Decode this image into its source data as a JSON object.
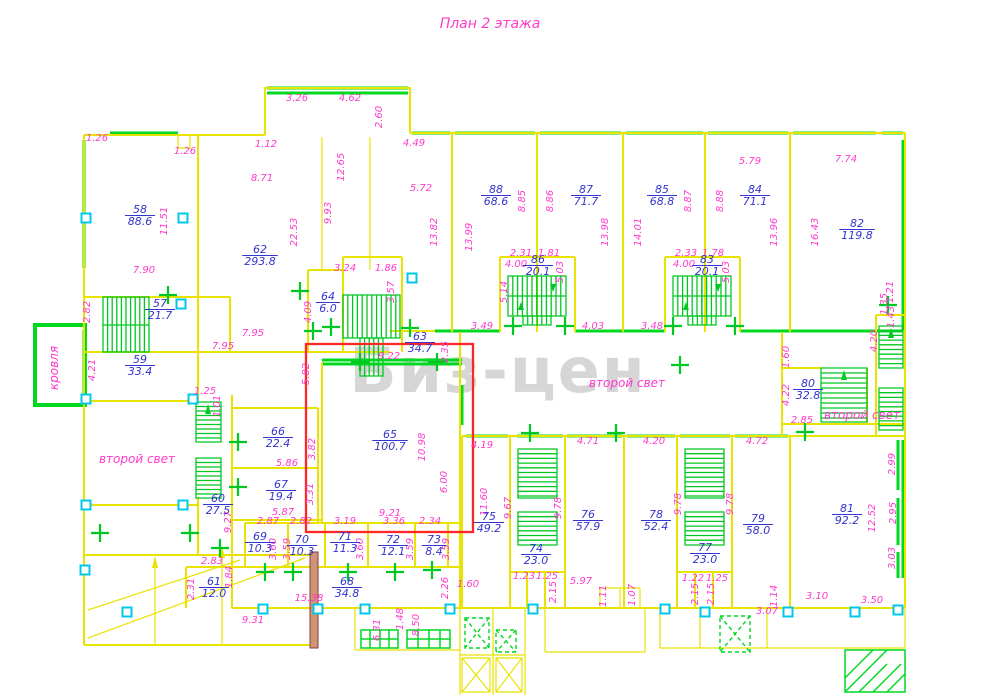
{
  "title": "План 2 этажа",
  "watermark": "Биз-цен",
  "colors": {
    "wall": "#e8e300",
    "glazing": "#00d822",
    "dimension_text": "#ff39cc",
    "room_text": "#3434d0",
    "column_marker": "#00c8ea",
    "highlight": "#ff2626",
    "watermark": "#d6d6d6"
  },
  "annotations": [
    {
      "t": "второй свет",
      "x": 137,
      "y": 463,
      "r": 0
    },
    {
      "t": "второй свет",
      "x": 627,
      "y": 387,
      "r": 0
    },
    {
      "t": "второй свет",
      "x": 862,
      "y": 419,
      "r": 0
    },
    {
      "t": "кровля",
      "x": 58,
      "y": 368,
      "r": 1
    }
  ],
  "rooms": [
    {
      "n": "58",
      "a": "88.6",
      "x": 140,
      "y": 213
    },
    {
      "n": "62",
      "a": "293.8",
      "x": 260,
      "y": 253
    },
    {
      "n": "57",
      "a": "21.7",
      "x": 160,
      "y": 307
    },
    {
      "n": "59",
      "a": "33.4",
      "x": 140,
      "y": 363
    },
    {
      "n": "60",
      "a": "27.5",
      "x": 218,
      "y": 502
    },
    {
      "n": "61",
      "a": "12.0",
      "x": 214,
      "y": 585
    },
    {
      "n": "63",
      "a": "34.7",
      "x": 420,
      "y": 340
    },
    {
      "n": "64",
      "a": "6.0",
      "x": 328,
      "y": 300
    },
    {
      "n": "65",
      "a": "100.7",
      "x": 390,
      "y": 438
    },
    {
      "n": "66",
      "a": "22.4",
      "x": 278,
      "y": 435
    },
    {
      "n": "67",
      "a": "19.4",
      "x": 281,
      "y": 488
    },
    {
      "n": "68",
      "a": "34.8",
      "x": 347,
      "y": 585
    },
    {
      "n": "69",
      "a": "10.3",
      "x": 260,
      "y": 540
    },
    {
      "n": "70",
      "a": "10.3",
      "x": 302,
      "y": 543
    },
    {
      "n": "71",
      "a": "11.3",
      "x": 345,
      "y": 540
    },
    {
      "n": "72",
      "a": "12.1",
      "x": 393,
      "y": 543
    },
    {
      "n": "73",
      "a": "8.4",
      "x": 434,
      "y": 543
    },
    {
      "n": "74",
      "a": "23.0",
      "x": 536,
      "y": 552
    },
    {
      "n": "75",
      "a": "49.2",
      "x": 489,
      "y": 520
    },
    {
      "n": "76",
      "a": "57.9",
      "x": 588,
      "y": 518
    },
    {
      "n": "77",
      "a": "23.0",
      "x": 705,
      "y": 551
    },
    {
      "n": "78",
      "a": "52.4",
      "x": 656,
      "y": 518
    },
    {
      "n": "79",
      "a": "58.0",
      "x": 758,
      "y": 522
    },
    {
      "n": "80",
      "a": "32.8",
      "x": 808,
      "y": 387
    },
    {
      "n": "81",
      "a": "92.2",
      "x": 847,
      "y": 512
    },
    {
      "n": "82",
      "a": "119.8",
      "x": 857,
      "y": 227
    },
    {
      "n": "83",
      "a": "20.1",
      "x": 707,
      "y": 263
    },
    {
      "n": "84",
      "a": "71.1",
      "x": 755,
      "y": 193
    },
    {
      "n": "85",
      "a": "68.8",
      "x": 662,
      "y": 193
    },
    {
      "n": "86",
      "a": "20.1",
      "x": 538,
      "y": 263
    },
    {
      "n": "87",
      "a": "71.7",
      "x": 586,
      "y": 193
    },
    {
      "n": "88",
      "a": "68.6",
      "x": 496,
      "y": 193
    }
  ],
  "dimensions": [
    {
      "t": "1.26",
      "x": 97,
      "y": 141
    },
    {
      "t": "1.26",
      "x": 185,
      "y": 154
    },
    {
      "t": "1.12",
      "x": 266,
      "y": 147
    },
    {
      "t": "8.71",
      "x": 262,
      "y": 181
    },
    {
      "t": "11.51",
      "x": 167,
      "y": 221,
      "r": 1
    },
    {
      "t": "7.90",
      "x": 144,
      "y": 273
    },
    {
      "t": "22.53",
      "x": 297,
      "y": 232,
      "r": 1
    },
    {
      "t": "3.26",
      "x": 297,
      "y": 101
    },
    {
      "t": "4.62",
      "x": 350,
      "y": 101
    },
    {
      "t": "2.60",
      "x": 382,
      "y": 117,
      "r": 1
    },
    {
      "t": "12.65",
      "x": 344,
      "y": 167,
      "r": 1
    },
    {
      "t": "9.93",
      "x": 331,
      "y": 213,
      "r": 1
    },
    {
      "t": "4.49",
      "x": 414,
      "y": 146
    },
    {
      "t": "5.72",
      "x": 421,
      "y": 191
    },
    {
      "t": "13.82",
      "x": 437,
      "y": 232,
      "r": 1
    },
    {
      "t": "13.99",
      "x": 472,
      "y": 237,
      "r": 1
    },
    {
      "t": "8.85",
      "x": 525,
      "y": 201,
      "r": 1
    },
    {
      "t": "8.86",
      "x": 553,
      "y": 201,
      "r": 1
    },
    {
      "t": "2.31",
      "x": 521,
      "y": 256
    },
    {
      "t": "1.81",
      "x": 549,
      "y": 256
    },
    {
      "t": "4.00",
      "x": 516,
      "y": 267
    },
    {
      "t": "5.03",
      "x": 563,
      "y": 272,
      "r": 1
    },
    {
      "t": "5.14",
      "x": 507,
      "y": 292,
      "r": 1
    },
    {
      "t": "3.49",
      "x": 482,
      "y": 329
    },
    {
      "t": "4.03",
      "x": 593,
      "y": 329
    },
    {
      "t": "13.98",
      "x": 608,
      "y": 232,
      "r": 1
    },
    {
      "t": "14.01",
      "x": 641,
      "y": 232,
      "r": 1
    },
    {
      "t": "8.87",
      "x": 691,
      "y": 201,
      "r": 1
    },
    {
      "t": "8.88",
      "x": 723,
      "y": 201,
      "r": 1
    },
    {
      "t": "5.79",
      "x": 750,
      "y": 164
    },
    {
      "t": "7.74",
      "x": 846,
      "y": 162
    },
    {
      "t": "13.96",
      "x": 777,
      "y": 232,
      "r": 1
    },
    {
      "t": "16.43",
      "x": 818,
      "y": 232,
      "r": 1
    },
    {
      "t": "2.33",
      "x": 686,
      "y": 256
    },
    {
      "t": "1.78",
      "x": 713,
      "y": 256
    },
    {
      "t": "4.00",
      "x": 684,
      "y": 267
    },
    {
      "t": "5.03",
      "x": 729,
      "y": 272,
      "r": 1
    },
    {
      "t": "3.48",
      "x": 652,
      "y": 329
    },
    {
      "t": "1.21",
      "x": 893,
      "y": 292,
      "r": 1
    },
    {
      "t": "1.35",
      "x": 887,
      "y": 304,
      "r": 1
    },
    {
      "t": "1.43",
      "x": 894,
      "y": 317,
      "r": 1
    },
    {
      "t": "4.20",
      "x": 877,
      "y": 341,
      "r": 1
    },
    {
      "t": "2.82",
      "x": 90,
      "y": 312,
      "r": 1
    },
    {
      "t": "7.95",
      "x": 253,
      "y": 336
    },
    {
      "t": "7.95",
      "x": 223,
      "y": 349
    },
    {
      "t": "4.21",
      "x": 95,
      "y": 370,
      "r": 1
    },
    {
      "t": "1.25",
      "x": 205,
      "y": 394
    },
    {
      "t": "1.01",
      "x": 220,
      "y": 406,
      "r": 1
    },
    {
      "t": "3.24",
      "x": 345,
      "y": 271
    },
    {
      "t": "1.86",
      "x": 386,
      "y": 271
    },
    {
      "t": "3.57",
      "x": 394,
      "y": 292,
      "r": 1
    },
    {
      "t": "4.09",
      "x": 311,
      "y": 312,
      "r": 1
    },
    {
      "t": "9.22",
      "x": 389,
      "y": 359
    },
    {
      "t": "2.35",
      "x": 448,
      "y": 352,
      "r": 1
    },
    {
      "t": "5.82",
      "x": 309,
      "y": 374,
      "r": 1
    },
    {
      "t": "3.82",
      "x": 315,
      "y": 449,
      "r": 1
    },
    {
      "t": "3.31",
      "x": 313,
      "y": 494,
      "r": 1
    },
    {
      "t": "10.98",
      "x": 425,
      "y": 447,
      "r": 1
    },
    {
      "t": "6.00",
      "x": 447,
      "y": 482,
      "r": 1
    },
    {
      "t": "9.21",
      "x": 390,
      "y": 516
    },
    {
      "t": "4.19",
      "x": 482,
      "y": 448
    },
    {
      "t": "11.60",
      "x": 487,
      "y": 502,
      "r": 1
    },
    {
      "t": "5.86",
      "x": 287,
      "y": 466
    },
    {
      "t": "5.87",
      "x": 283,
      "y": 515
    },
    {
      "t": "9.27",
      "x": 231,
      "y": 522,
      "r": 1
    },
    {
      "t": "2.87",
      "x": 268,
      "y": 524
    },
    {
      "t": "2.82",
      "x": 301,
      "y": 524
    },
    {
      "t": "3.19",
      "x": 345,
      "y": 524
    },
    {
      "t": "3.36",
      "x": 394,
      "y": 524
    },
    {
      "t": "2.34",
      "x": 430,
      "y": 524
    },
    {
      "t": "3.60",
      "x": 276,
      "y": 549,
      "r": 1
    },
    {
      "t": "3.59",
      "x": 290,
      "y": 549,
      "r": 1
    },
    {
      "t": "3.60",
      "x": 363,
      "y": 549,
      "r": 1
    },
    {
      "t": "3.59",
      "x": 413,
      "y": 549,
      "r": 1
    },
    {
      "t": "3.59",
      "x": 449,
      "y": 549,
      "r": 1
    },
    {
      "t": "2.83",
      "x": 212,
      "y": 564
    },
    {
      "t": "2.31",
      "x": 194,
      "y": 589,
      "r": 1
    },
    {
      "t": "1.84",
      "x": 232,
      "y": 577,
      "r": 1
    },
    {
      "t": "15.38",
      "x": 309,
      "y": 601
    },
    {
      "t": "9.31",
      "x": 253,
      "y": 623
    },
    {
      "t": "2.26",
      "x": 448,
      "y": 588,
      "r": 1
    },
    {
      "t": "1.60",
      "x": 468,
      "y": 587
    },
    {
      "t": "6.31",
      "x": 380,
      "y": 630,
      "r": 1
    },
    {
      "t": "1.48",
      "x": 403,
      "y": 619,
      "r": 1
    },
    {
      "t": "8.50",
      "x": 419,
      "y": 625,
      "r": 1
    },
    {
      "t": "1.23",
      "x": 524,
      "y": 579
    },
    {
      "t": "1.25",
      "x": 547,
      "y": 579
    },
    {
      "t": "5.97",
      "x": 581,
      "y": 584
    },
    {
      "t": "2.15",
      "x": 556,
      "y": 592,
      "r": 1
    },
    {
      "t": "1.11",
      "x": 606,
      "y": 596,
      "r": 1
    },
    {
      "t": "1.07",
      "x": 635,
      "y": 595,
      "r": 1
    },
    {
      "t": "4.71",
      "x": 588,
      "y": 444
    },
    {
      "t": "4.20",
      "x": 654,
      "y": 444
    },
    {
      "t": "4.72",
      "x": 757,
      "y": 444
    },
    {
      "t": "9.67",
      "x": 511,
      "y": 508,
      "r": 1
    },
    {
      "t": "9.78",
      "x": 561,
      "y": 508,
      "r": 1
    },
    {
      "t": "9.78",
      "x": 681,
      "y": 504,
      "r": 1
    },
    {
      "t": "9.78",
      "x": 733,
      "y": 504,
      "r": 1
    },
    {
      "t": "1.22",
      "x": 693,
      "y": 581
    },
    {
      "t": "1.25",
      "x": 717,
      "y": 581
    },
    {
      "t": "2.15",
      "x": 698,
      "y": 594,
      "r": 1
    },
    {
      "t": "2.15",
      "x": 714,
      "y": 594,
      "r": 1
    },
    {
      "t": "1.14",
      "x": 777,
      "y": 596,
      "r": 1
    },
    {
      "t": "3.10",
      "x": 817,
      "y": 599
    },
    {
      "t": "3.50",
      "x": 872,
      "y": 603
    },
    {
      "t": "3.07",
      "x": 767,
      "y": 614
    },
    {
      "t": "12.52",
      "x": 875,
      "y": 518,
      "r": 1
    },
    {
      "t": "2.99",
      "x": 895,
      "y": 464,
      "r": 1
    },
    {
      "t": "2.95",
      "x": 896,
      "y": 513,
      "r": 1
    },
    {
      "t": "3.03",
      "x": 895,
      "y": 558,
      "r": 1
    },
    {
      "t": "1.60",
      "x": 789,
      "y": 357,
      "r": 1
    },
    {
      "t": "4.22",
      "x": 789,
      "y": 395,
      "r": 1
    },
    {
      "t": "2.85",
      "x": 802,
      "y": 423
    }
  ]
}
